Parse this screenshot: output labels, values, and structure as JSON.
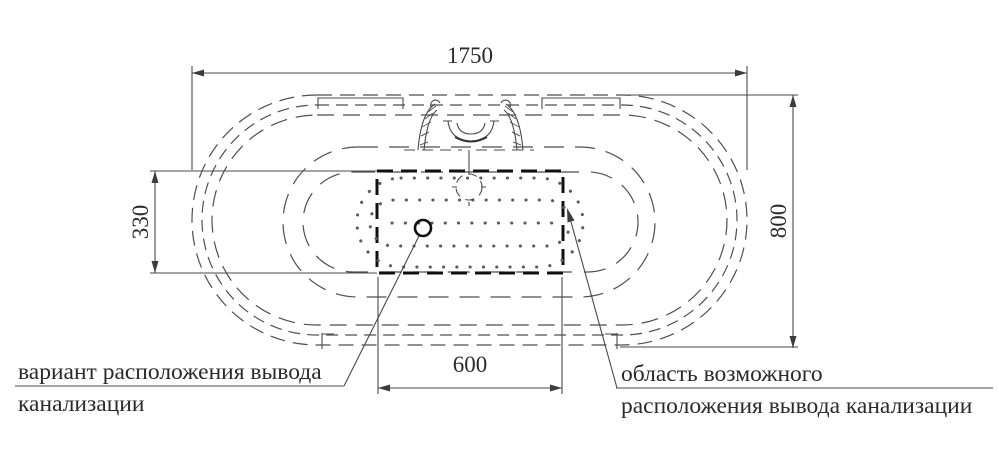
{
  "drawing": {
    "title": "bathtub-top-view-installation-diagram",
    "dimensions": {
      "overall_length": "1750",
      "overall_width": "800",
      "outlet_area_height": "330",
      "outlet_area_width": "600"
    },
    "labels": {
      "variant_line1": "вариант расположения вывода",
      "variant_line2": "канализации",
      "area_line1": "область возможного",
      "area_line2": "расположения вывода канализации"
    },
    "colors": {
      "line": "#4a4a4a",
      "bold_line": "#101010",
      "text": "#2a2a2a",
      "background": "#ffffff"
    }
  }
}
